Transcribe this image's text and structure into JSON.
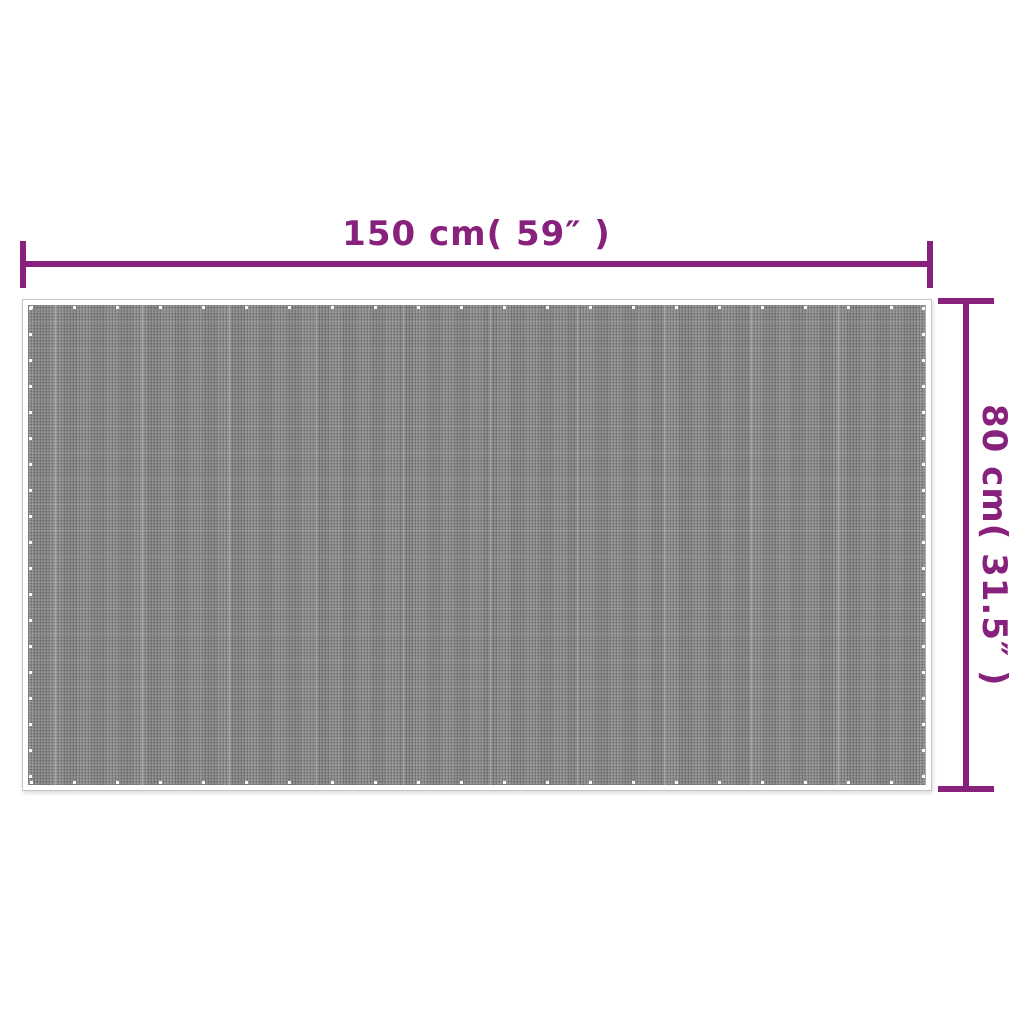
{
  "colors": {
    "accent": "#87217B",
    "mat-base": "#8F8F8F",
    "mat-outline": "#C6C6C6",
    "page-bg": "#FFFFFF"
  },
  "dimensions": {
    "width": {
      "label": "150 cm( 59″ )",
      "value_cm": 150,
      "value_inches": 59
    },
    "height": {
      "label": "80 cm( 31.5″ )",
      "value_cm": 80,
      "value_inches": 31.5
    }
  }
}
